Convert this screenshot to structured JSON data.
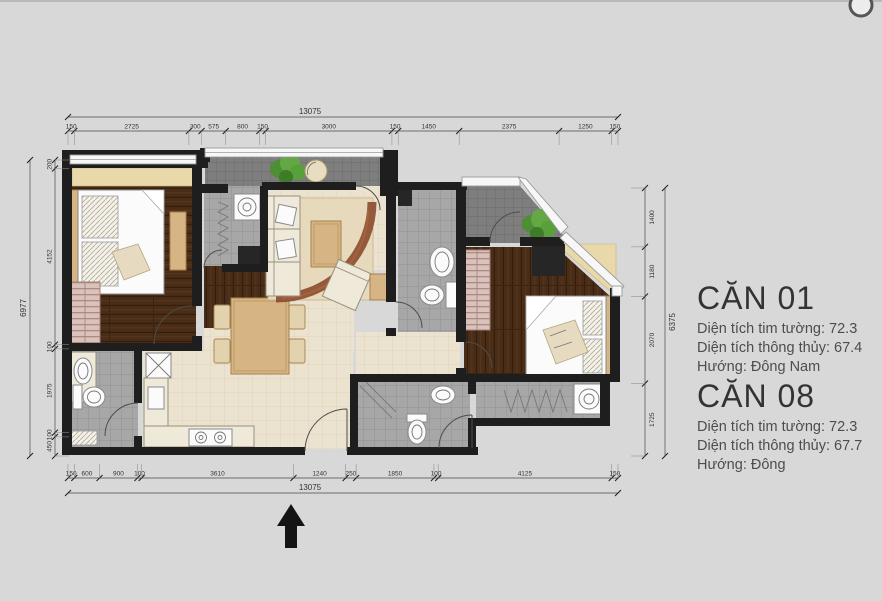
{
  "drawing": {
    "type": "apartment-floor-plan",
    "icons": {
      "north_arrow": "entrance-arrow-up",
      "plants": "potted-plant",
      "logo_fragment": "partial-circle-logo"
    }
  },
  "dimensions": {
    "top": {
      "total": "13075",
      "segments": [
        "150",
        "2725",
        "300",
        "575",
        "800",
        "150",
        "3000",
        "150",
        "1450",
        "2375",
        "1250",
        "150"
      ]
    },
    "bottom": {
      "total": "13075",
      "segments": [
        "150",
        "600",
        "900",
        "100",
        "3610",
        "1240",
        "250",
        "1850",
        "100",
        "4125",
        "150"
      ]
    },
    "left": {
      "total": "6977",
      "segments": [
        "200",
        "4152",
        "100",
        "1975",
        "100",
        "450"
      ]
    },
    "right": {
      "total": "6375",
      "segments": [
        "1400",
        "1180",
        "2070",
        "1725"
      ]
    }
  },
  "units": [
    {
      "title": "CĂN 01",
      "lines": [
        "Diện tích tim tường: 72.3",
        "Diện tích thông thủy: 67.4",
        "Hướng: Đông Nam"
      ]
    },
    {
      "title": "CĂN 08",
      "lines": [
        "Diện tích tim tường: 72.3",
        "Diện tích thông thủy: 67.7",
        "Hướng: Đông"
      ]
    }
  ],
  "palette": {
    "background": "#d8d8d8",
    "wall": "#1e1e1e",
    "wood_floor": "#4a2d17",
    "tile_floor": "#a7a7a7",
    "balcony_floor": "#7e7e7e",
    "cream_floor": "#ebe3cf",
    "plant_green": "#5a9e3c",
    "dimension_text": "#333333",
    "title_text": "#333333",
    "body_text": "#4d4d4d"
  }
}
